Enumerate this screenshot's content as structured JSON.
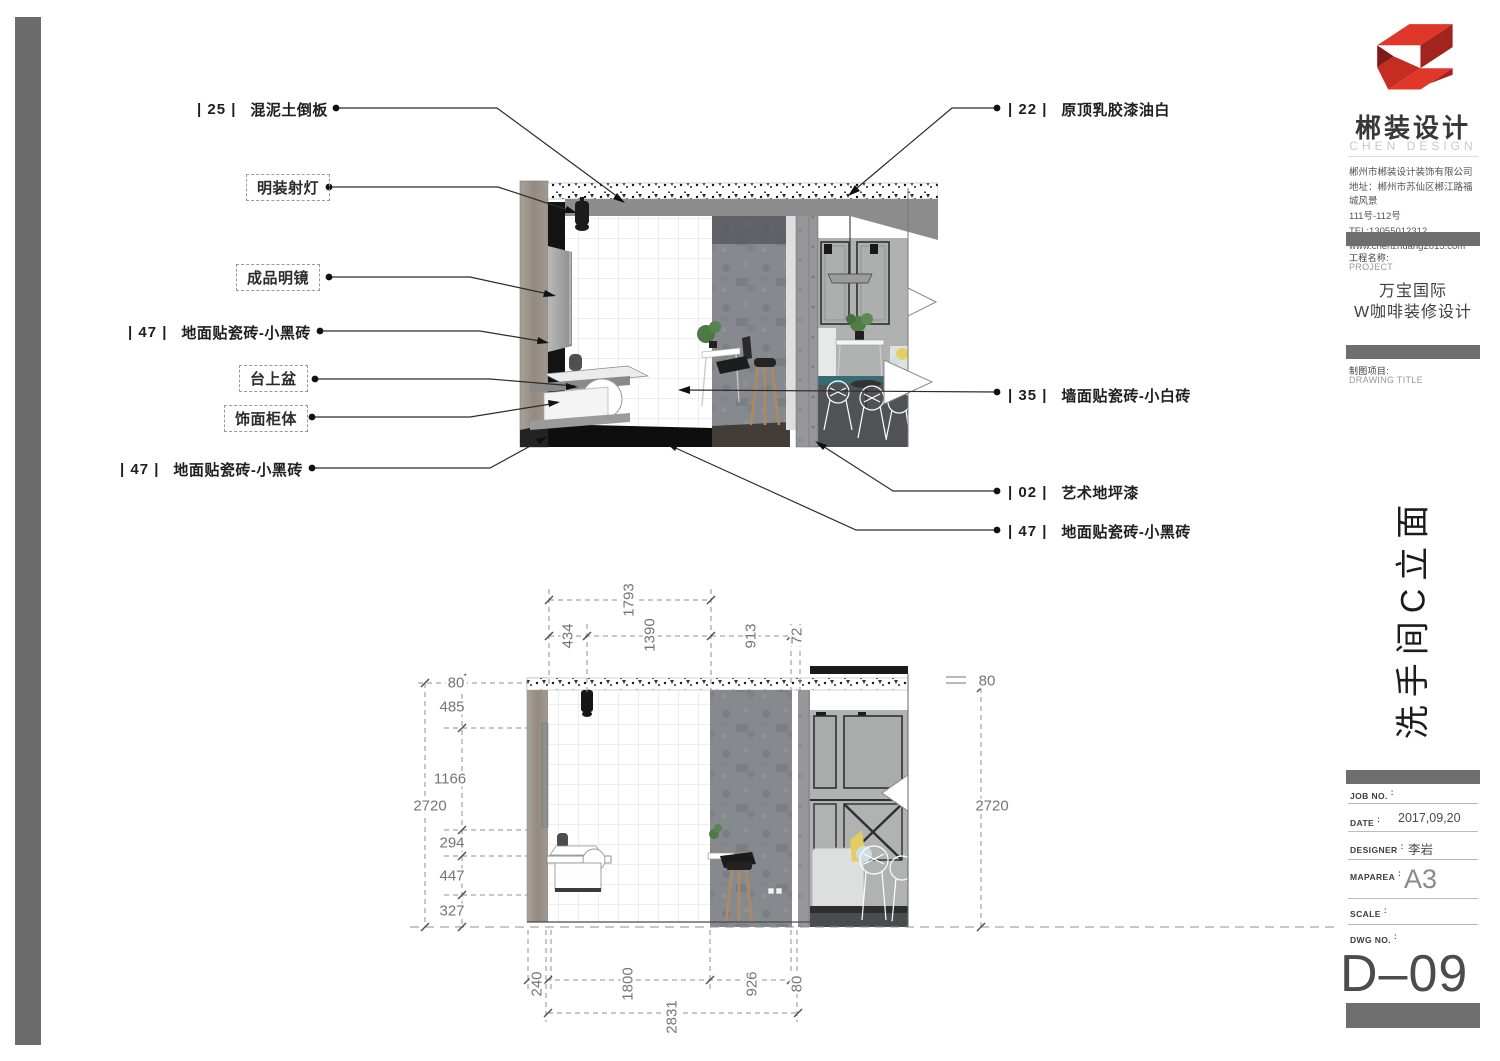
{
  "sheet": {
    "callouts_left": [
      {
        "code": "| 25 |",
        "text": "混泥土倒板"
      },
      {
        "text": "明装射灯"
      },
      {
        "text": "成品明镜"
      },
      {
        "code": "| 47 |",
        "text": "地面贴瓷砖-小黑砖"
      },
      {
        "text": "台上盆"
      },
      {
        "text": "饰面柜体"
      },
      {
        "code": "| 47 |",
        "text": "地面贴瓷砖-小黑砖"
      }
    ],
    "callouts_right": [
      {
        "code": "| 22 |",
        "text": "原顶乳胶漆油白"
      },
      {
        "code": "| 35 |",
        "text": "墙面贴瓷砖-小白砖"
      },
      {
        "code": "| 02 |",
        "text": "艺术地坪漆"
      },
      {
        "code": "| 47 |",
        "text": "地面贴瓷砖-小黑砖"
      }
    ],
    "dims": {
      "top_overall": "1793",
      "top": [
        "434",
        "1390",
        "913",
        "72"
      ],
      "left": [
        "80",
        "485",
        "1166",
        "294",
        "447",
        "327"
      ],
      "left_overall": "2720",
      "right": [
        "80",
        "2720"
      ],
      "bottom": [
        "240",
        "1800",
        "926",
        "80"
      ],
      "bottom_overall": "2831"
    }
  },
  "titleblock": {
    "brand_cn": "郴装设计",
    "brand_en": "CHEN DESIGN",
    "company_lines": [
      "郴州市郴装设计装饰有限公司",
      "地址：郴州市苏仙区郴江路福城风景",
      "111号-112号",
      "TEL:13055012312",
      "www.chenzhuang2015.com"
    ],
    "project_label_cn": "工程名称:",
    "project_label_en": "PROJECT",
    "project_name_1": "万宝国际",
    "project_name_2": "W咖啡装修设计",
    "drawing_label_cn": "制图项目:",
    "drawing_label_en": "DRAWING TITLE",
    "drawing_title": "洗手间C立面",
    "colon": ":",
    "fields": [
      {
        "label": "JOB NO.",
        "value": ""
      },
      {
        "label": "DATE",
        "value": "2017,09,20"
      },
      {
        "label": "DESIGNER",
        "value": "李岩"
      },
      {
        "label": "MAPAREA",
        "value": "A3"
      },
      {
        "label": "SCALE",
        "value": ""
      },
      {
        "label": "DWG NO.",
        "value": ""
      }
    ],
    "dwg_code": "D–09"
  },
  "colors": {
    "accent_red": "#d9392b",
    "bar_gray": "#6e6e6e"
  }
}
